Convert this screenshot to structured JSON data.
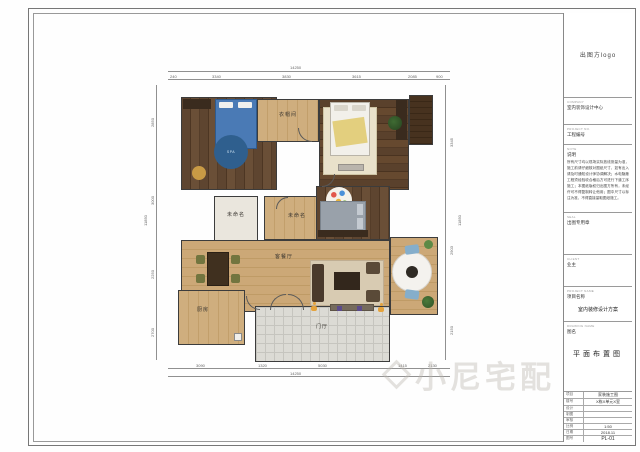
{
  "sheet": {
    "logo_text": "出图方logo",
    "watermark": "小尼宅配"
  },
  "title_block": {
    "company": {
      "caps": "COMPANY",
      "text": "室内装饰设计中心"
    },
    "project_no": {
      "caps": "PROJECT NO.",
      "text": "工程编号"
    },
    "note": {
      "caps": "NOTE",
      "text": "说明",
      "body": "所有尺寸均以现场实际放线测量为准，施工前请仔细核对图纸尺寸，如有出入请及时通知设计师协调解决；水电隐蔽工程须经验收合格后方可进行下道工序施工；本图纸版权归出图方所有，未经许可不得复制转让他用；图中尺寸以标注为准，不得直接量取图纸施工。"
    },
    "seal": {
      "caps": "SEAL",
      "text": "出图专用章"
    },
    "client": {
      "caps": "CLIENT",
      "text": "业主"
    },
    "project_name": {
      "caps": "PROJECT NAME",
      "text": "项目名称",
      "value": "室内装修设计方案"
    },
    "drawing_name": {
      "caps": "DRAWING NAME",
      "text": "图名",
      "value": "平面布置图"
    },
    "table": [
      {
        "label": "项目",
        "value": "家装施工图"
      },
      {
        "label": "楼号",
        "value": "X栋X单元X室"
      },
      {
        "label": "设计",
        "value": ""
      },
      {
        "label": "制图",
        "value": ""
      },
      {
        "label": "审核",
        "value": ""
      },
      {
        "label": "比例",
        "value": "1:50"
      },
      {
        "label": "日期",
        "value": "2018.11"
      },
      {
        "label": "图号",
        "value": "PL-01"
      }
    ]
  },
  "plan": {
    "rooms": {
      "closet": "衣帽间",
      "unnamed1": "未命名",
      "unnamed2": "未命名",
      "living": "客餐厅",
      "kitchen": "厨房",
      "entry": "门厅"
    },
    "rug_text": "SPA",
    "dims": {
      "top_total": "14250",
      "top_segments": [
        "240",
        "3340",
        "3830",
        "3615",
        "2085",
        "900"
      ],
      "bottom_segments": [
        "3090",
        "1320",
        "5030",
        "1415",
        "2130"
      ],
      "bottom_total": "14250",
      "left_segments": [
        "2850",
        "3000",
        "2250",
        "2700"
      ],
      "left_total": "11850",
      "right_segments": [
        "3345",
        "2903",
        "2150"
      ],
      "right_total": "11850"
    }
  }
}
